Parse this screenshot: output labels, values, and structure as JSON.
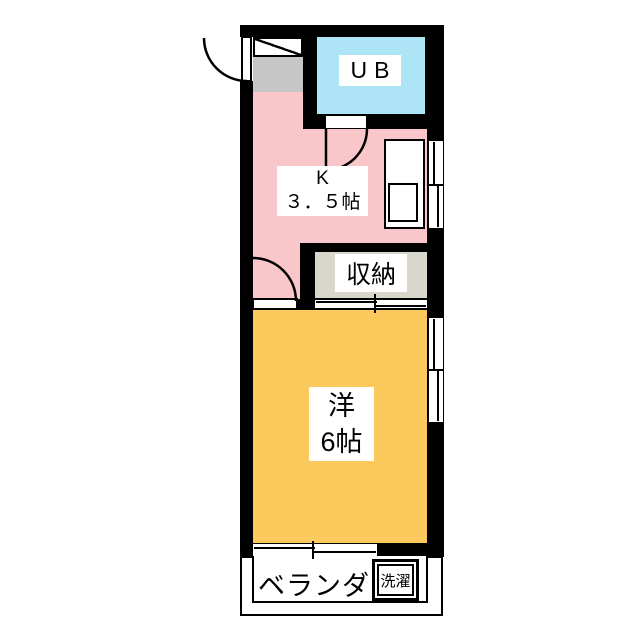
{
  "floorplan": {
    "ub": {
      "label": "UB"
    },
    "kitchen": {
      "name_label": "K",
      "size_label": "３．５帖"
    },
    "storage": {
      "label": "収納"
    },
    "room": {
      "name_label": "洋",
      "size_label": "6帖"
    },
    "veranda": {
      "label": "ベランダ"
    },
    "laundry": {
      "label": "洗濯"
    },
    "colors": {
      "kitchen_pink": "#f9c6ca",
      "unit_bath_blue": "#aee5f6",
      "western_room_orange": "#fcc95c",
      "storage_gray": "#d9d6cb",
      "genkan_gray": "#c6c6c6",
      "wall_black": "#000000",
      "background_white": "#ffffff"
    }
  }
}
